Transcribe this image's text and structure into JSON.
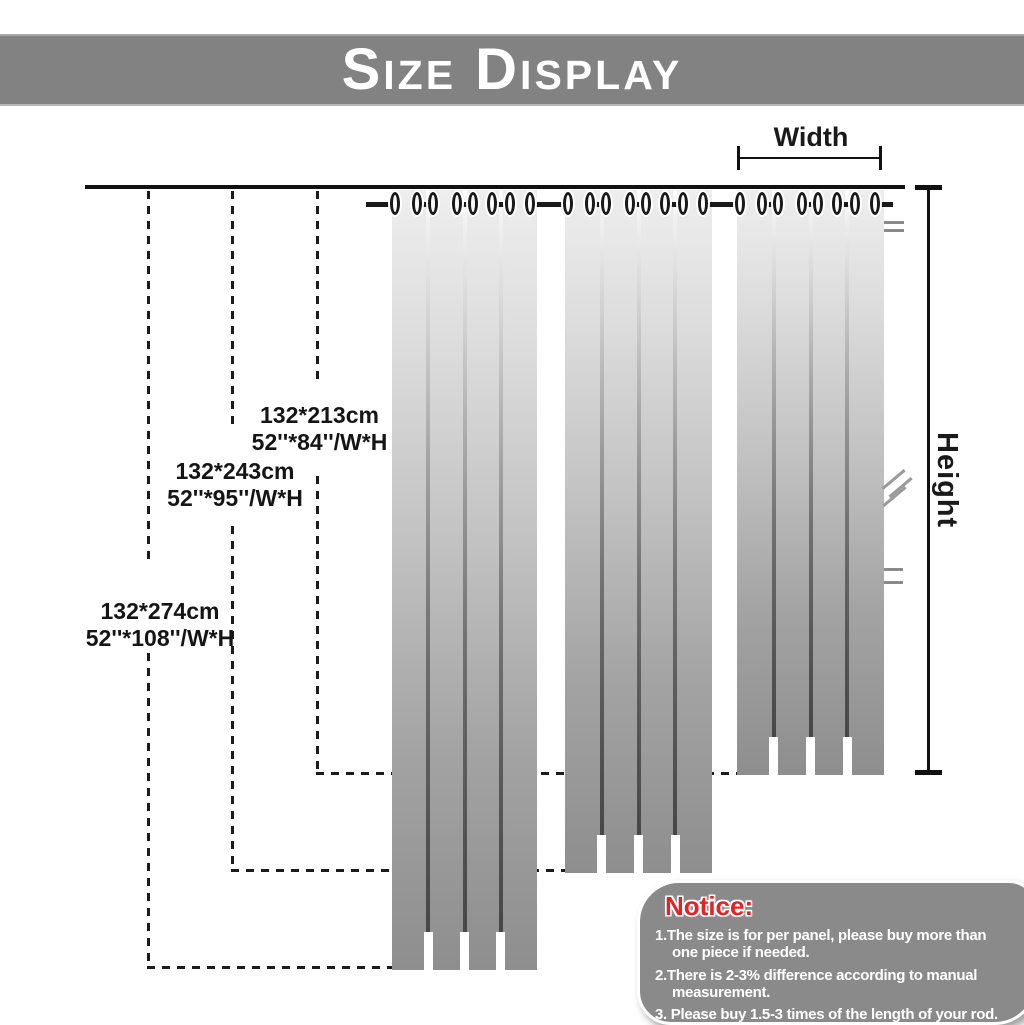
{
  "header": {
    "title": "Size Display"
  },
  "diagram": {
    "width_label": "Width",
    "height_label": "Height",
    "panel_sizes": [
      {
        "cm": "132*213cm",
        "inches": "52''*84''/W*H"
      },
      {
        "cm": "132*243cm",
        "inches": "52''*95''/W*H"
      },
      {
        "cm": "132*274cm",
        "inches": "52''*108''/W*H"
      }
    ]
  },
  "notice": {
    "title": "Notice:",
    "items": [
      "1.The size is for per panel, please buy more than\none piece if needed.",
      "2.There is 2-3% difference according to manual\nmeasurement.",
      "3. Please buy 1.5-3 times of the length of your rod."
    ]
  },
  "colors": {
    "banner_bg": "#828282",
    "banner_text": "#ffffff",
    "notice_bg": "#8a8a8a",
    "notice_title": "#e32226",
    "notice_text": "#ffffff",
    "curtain_top": "#eeeeee",
    "curtain_bottom": "#8e8e8e",
    "line": "#1c1c1c"
  }
}
